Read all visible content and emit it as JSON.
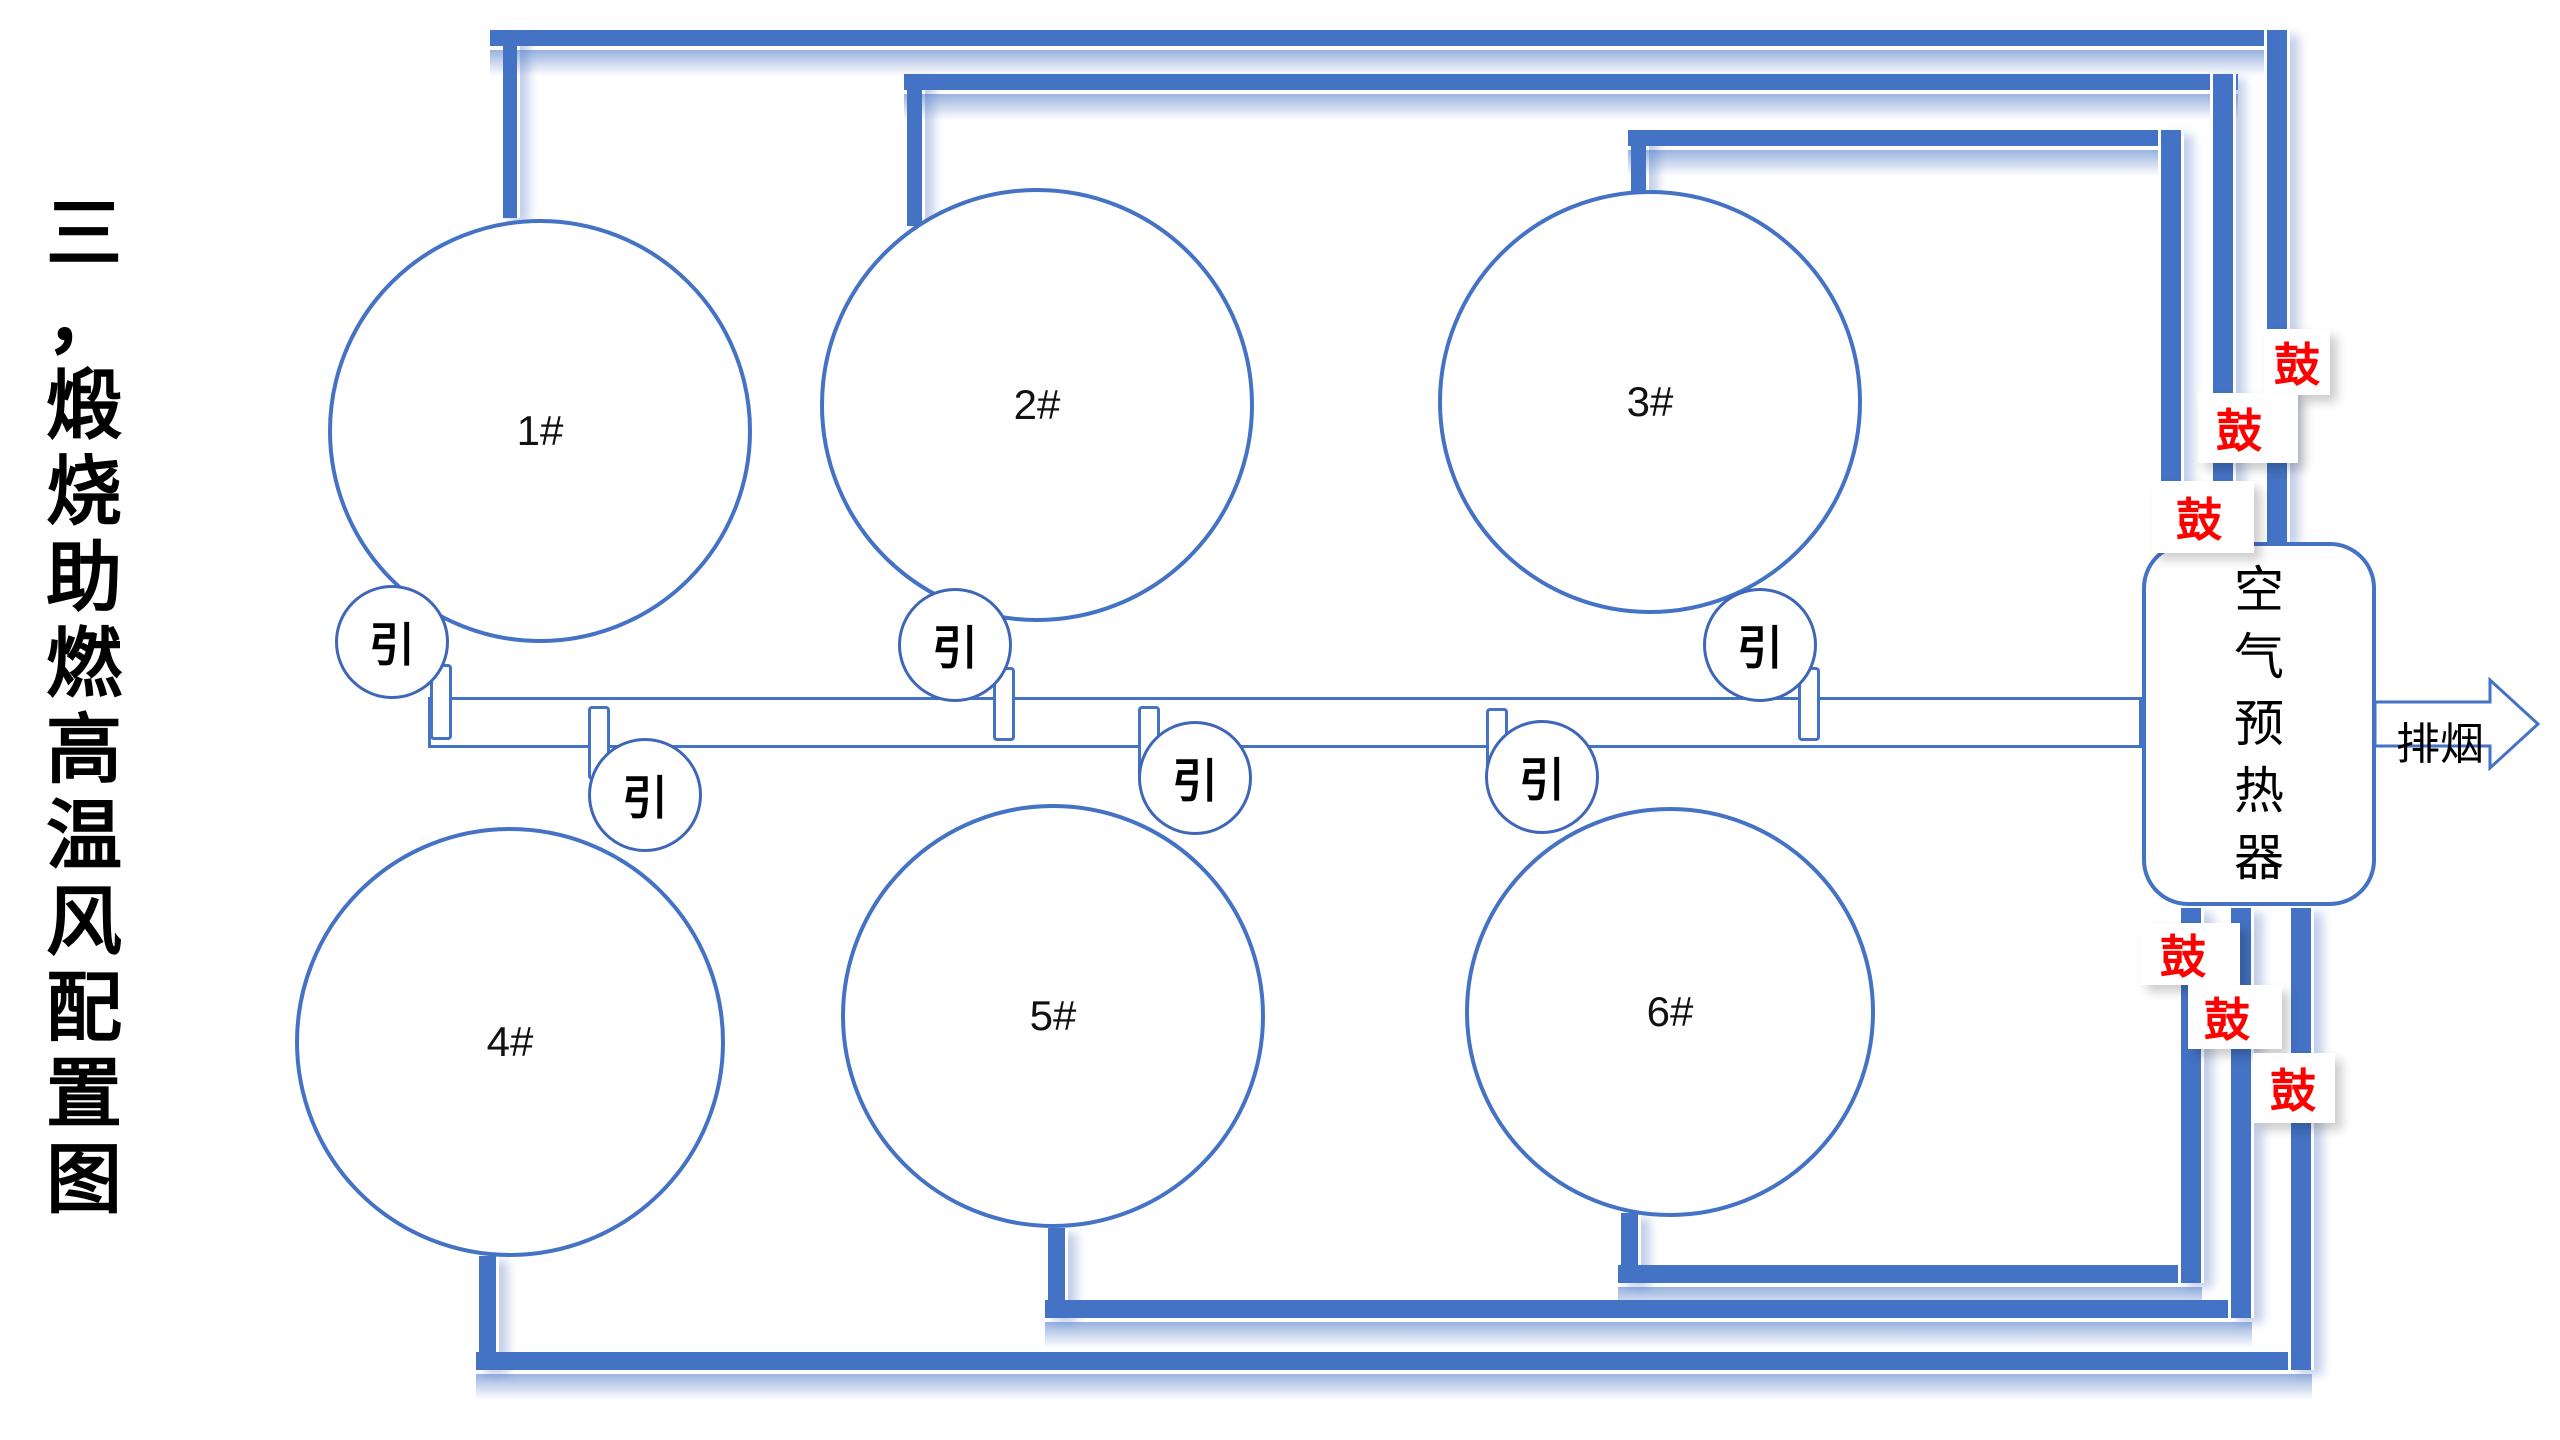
{
  "title": {
    "text": "三，煅烧助燃高温风配置图",
    "chars": [
      "三",
      "，",
      "煅",
      "烧",
      "助",
      "燃",
      "高",
      "温",
      "风",
      "配",
      "置",
      "图"
    ]
  },
  "kilns": [
    {
      "id": "kiln-1",
      "label": "1#"
    },
    {
      "id": "kiln-2",
      "label": "2#"
    },
    {
      "id": "kiln-3",
      "label": "3#"
    },
    {
      "id": "kiln-4",
      "label": "4#"
    },
    {
      "id": "kiln-5",
      "label": "5#"
    },
    {
      "id": "kiln-6",
      "label": "6#"
    }
  ],
  "induced_fans": [
    {
      "id": "induced-fan-1",
      "label": "引"
    },
    {
      "id": "induced-fan-2",
      "label": "引"
    },
    {
      "id": "induced-fan-3",
      "label": "引"
    },
    {
      "id": "induced-fan-4",
      "label": "引"
    },
    {
      "id": "induced-fan-5",
      "label": "引"
    },
    {
      "id": "induced-fan-6",
      "label": "引"
    }
  ],
  "forced_fans": [
    {
      "id": "forced-fan-1",
      "label": "鼓"
    },
    {
      "id": "forced-fan-2",
      "label": "鼓"
    },
    {
      "id": "forced-fan-3",
      "label": "鼓"
    },
    {
      "id": "forced-fan-4",
      "label": "鼓"
    },
    {
      "id": "forced-fan-5",
      "label": "鼓"
    },
    {
      "id": "forced-fan-6",
      "label": "鼓"
    }
  ],
  "preheater": {
    "label": "空气预热器",
    "chars": [
      "空",
      "气",
      "预",
      "热",
      "器"
    ]
  },
  "exhaust_label": "排烟",
  "colors": {
    "pipe_blue": "#4472C4",
    "outline_blue": "#4472C4",
    "forced_fan_red": "#FF0000",
    "text_black": "#000000",
    "background": "#FFFFFF"
  }
}
